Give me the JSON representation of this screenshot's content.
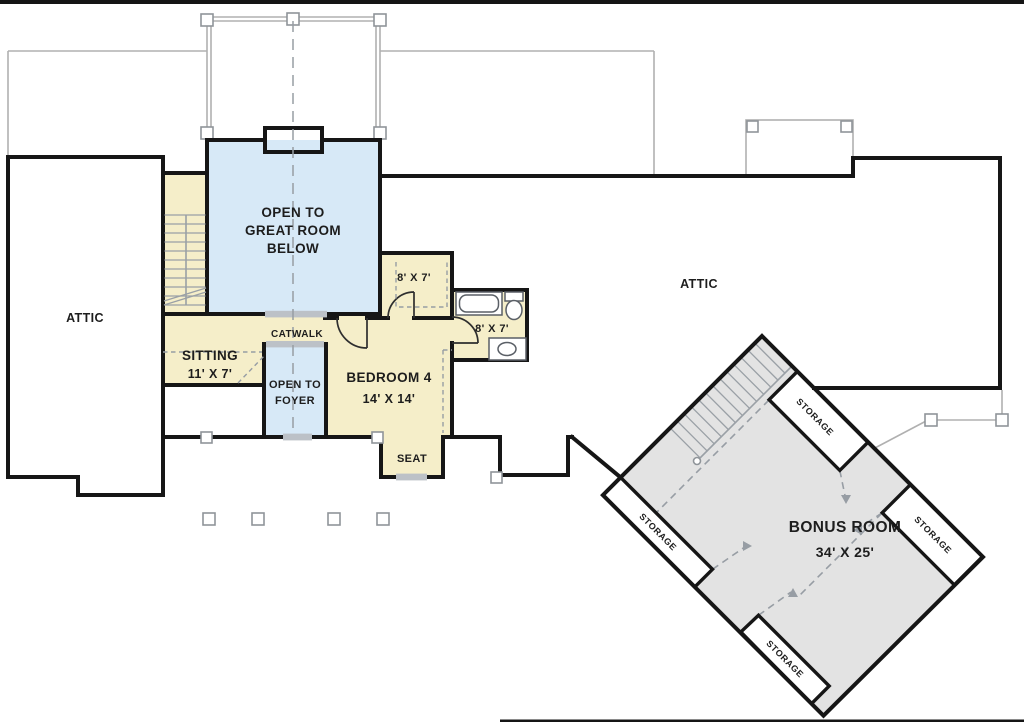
{
  "plan": {
    "rooms": {
      "attic_left": "ATTIC",
      "attic_right": "ATTIC",
      "great_room_open": {
        "line1": "OPEN TO",
        "line2": "GREAT ROOM",
        "line3": "BELOW"
      },
      "catwalk": "CATWALK",
      "sitting": {
        "name": "SITTING",
        "dim": "11' X 7'"
      },
      "foyer_open": {
        "line1": "OPEN TO",
        "line2": "FOYER"
      },
      "bedroom4": {
        "name": "BEDROOM 4",
        "dim": "14' X 14'"
      },
      "closet": {
        "dim": "8' X 7'"
      },
      "bath": {
        "dim": "8' X 7'"
      },
      "seat": "SEAT",
      "bonus": {
        "name": "BONUS ROOM",
        "dim": "34' X 25'"
      },
      "storage_top": "STORAGE",
      "storage_right": "STORAGE",
      "storage_left": "STORAGE",
      "storage_bottom": "STORAGE"
    },
    "colors": {
      "wall": "#161616",
      "yellow": "#f5eec9",
      "blue": "#d7e9f7",
      "gray": "#e3e3e3",
      "linegray": "#979da4",
      "roof": "#b0b0b0",
      "opening": "#bcc1c7",
      "text": "#1d1d1d"
    }
  }
}
